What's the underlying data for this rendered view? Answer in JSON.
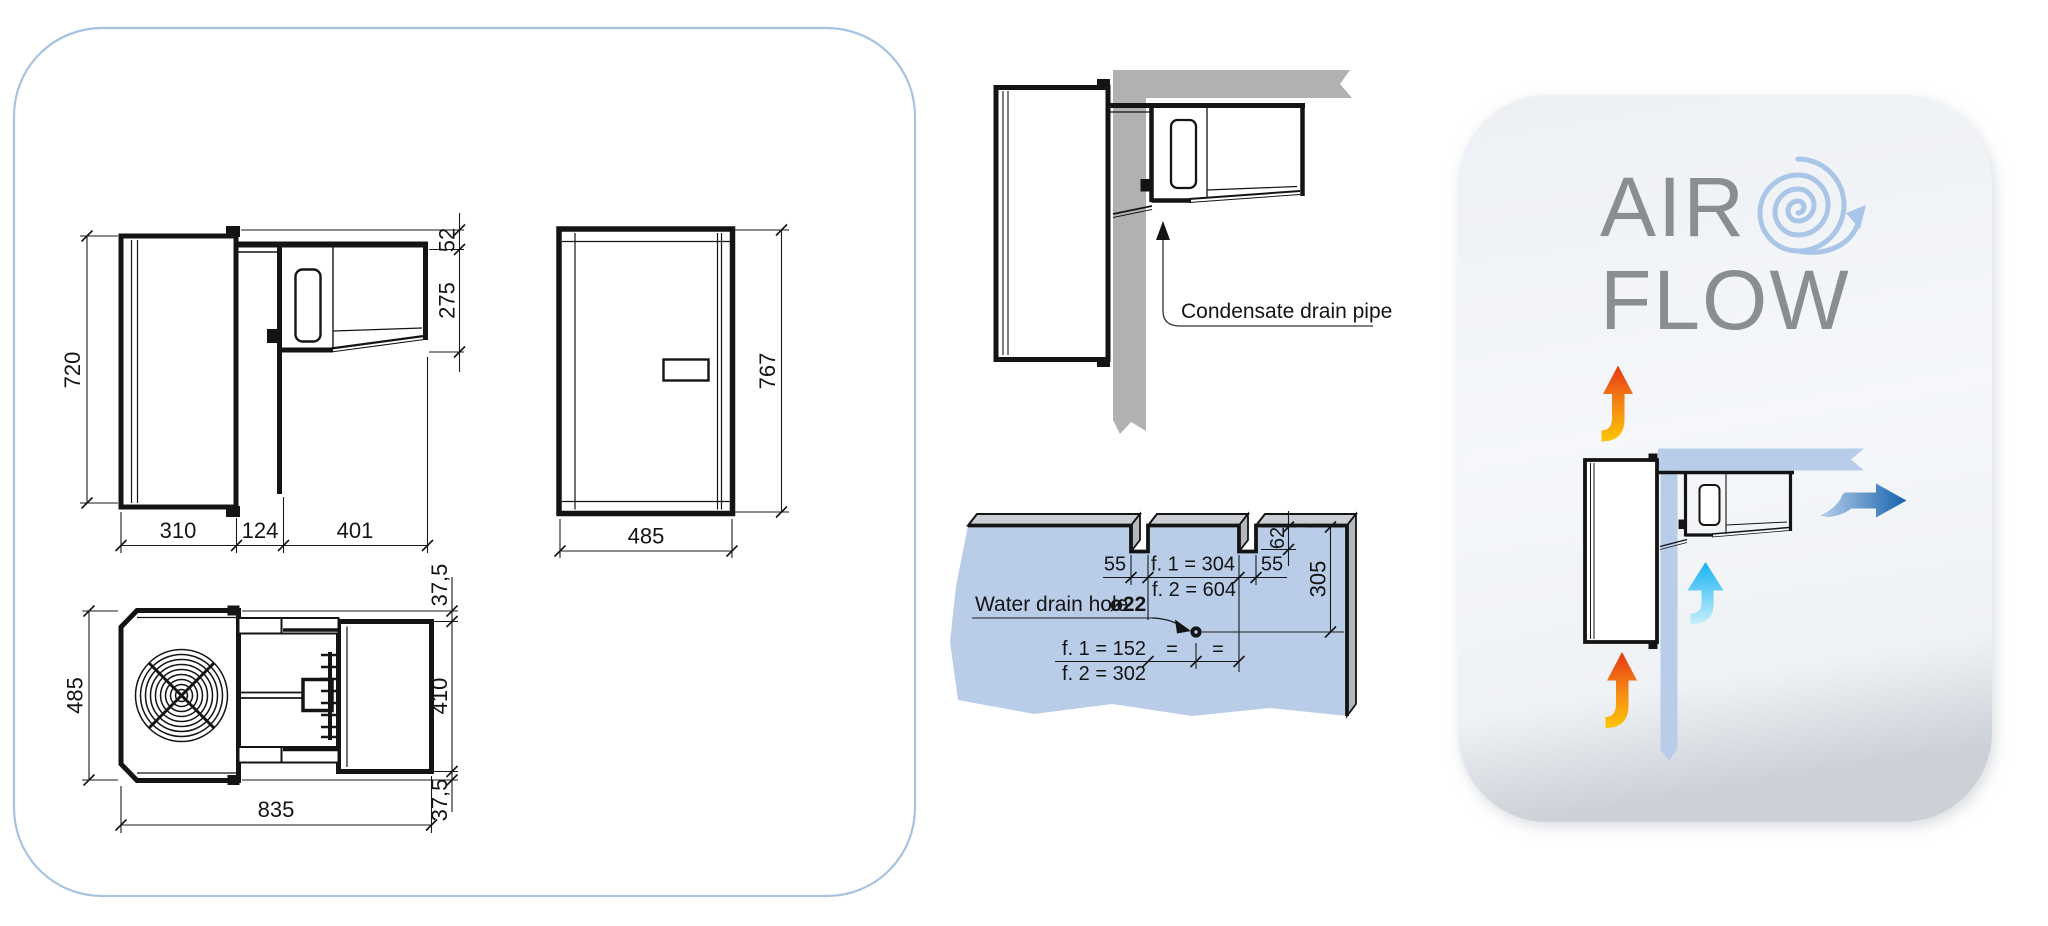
{
  "drawing_panel": {
    "side_view": {
      "dim_height": "720",
      "dim_top_offset": "52",
      "dim_condenser_height": "275",
      "dim_depth_inside": "310",
      "dim_wall_thickness": "124",
      "dim_depth_outside": "401"
    },
    "front_view": {
      "dim_width": "485",
      "dim_height": "767"
    },
    "top_view": {
      "dim_width": "485",
      "dim_margin_top": "37,5",
      "dim_evaporator_depth": "410",
      "dim_margin_bottom": "37,5",
      "dim_length": "835"
    }
  },
  "installation": {
    "condensate_label": "Condensate drain pipe",
    "drain": {
      "dim_notch_left": "55",
      "dim_f1_span": "f. 1 = 304",
      "dim_f2_span": "f. 2 = 604",
      "dim_notch_right": "55",
      "dim_notch_depth": "62",
      "dim_hole_drop": "305",
      "label": "Water drain hole",
      "diameter": "ø22",
      "dim_f1_offset": "f. 1 = 152",
      "dim_f2_offset": "f. 2 = 302",
      "equal_left": "=",
      "equal_right": "="
    }
  },
  "airflow": {
    "title_line1": "AIR",
    "title_line2": "FLOW"
  },
  "colors": {
    "panel_border_blue": "#a6c3e1",
    "wall_blue": "#b9cde9",
    "wall_gray": "#b0b1b3",
    "line_black": "#141414",
    "airflow_text_gray": "#8a8d91",
    "swirl_blue": "#a9c5e7",
    "hot_arrow_top": "#e63512",
    "hot_arrow_bottom": "#fdc504",
    "cold_arrow": "#14b2f2",
    "out_arrow": "#17599f"
  }
}
